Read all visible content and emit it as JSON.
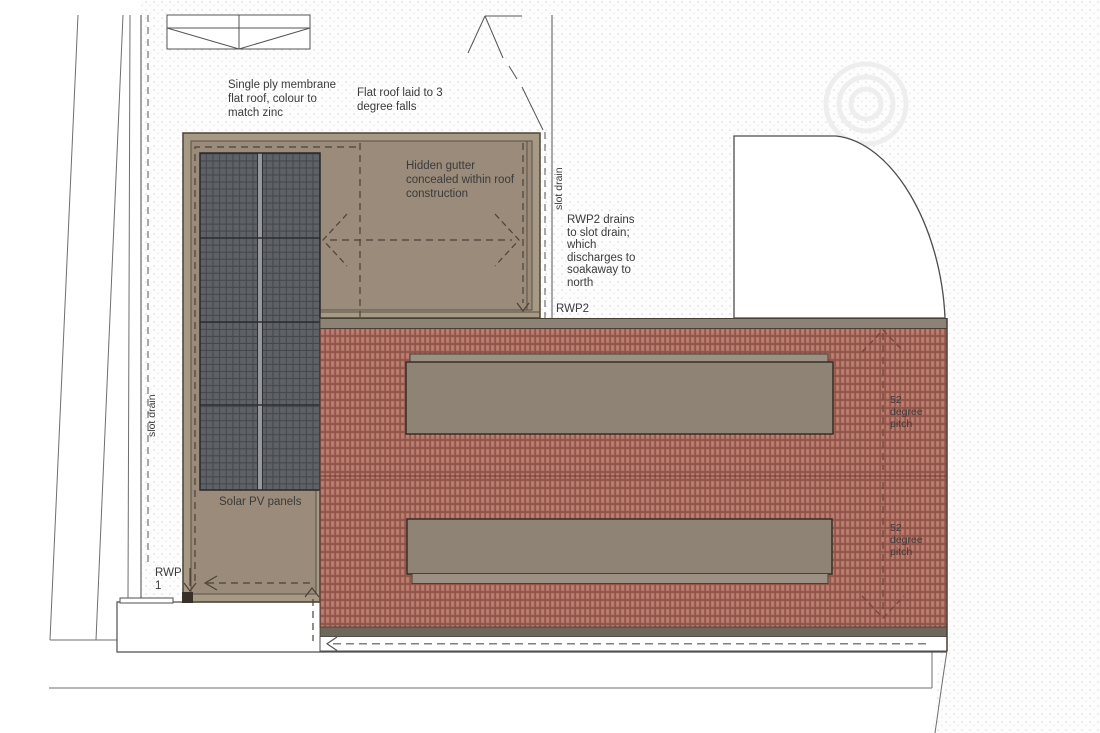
{
  "drawing": {
    "title": "Roof plan",
    "notes": {
      "membrane": "Single ply membrane\nflat roof, colour to\nmatch zinc",
      "falls": "Flat roof laid to 3\ndegree falls",
      "hidden_gutter": "Hidden gutter\nconcealed within roof\nconstruction",
      "rwp2_note": "RWP2 drains\nto slot drain;\nwhich\ndischarges to\nsoakaway to\nnorth"
    },
    "labels": {
      "slot_drain_left": "slot drain",
      "slot_drain_right": "slot drain",
      "rwp1": "RWP\n1",
      "rwp2": "RWP2",
      "solar_pv": "Solar PV panels",
      "pitch_upper": "52\ndegree\npitch",
      "pitch_lower": "52\ndegree\npitch"
    },
    "colors": {
      "flat_roof_margin": "#a79a85",
      "flat_roof_surface": "#9a8b7a",
      "pv_panel": "#5e6165",
      "pv_grid_line": "#44474b",
      "tile_base": "#b47468",
      "tile_mortar": "#8f5449",
      "ridge_band": "#8c8276",
      "eave_band": "#6f675c",
      "rooflight_box": "#8f8375",
      "text": "#3b3b3b",
      "line": "#555555"
    }
  }
}
